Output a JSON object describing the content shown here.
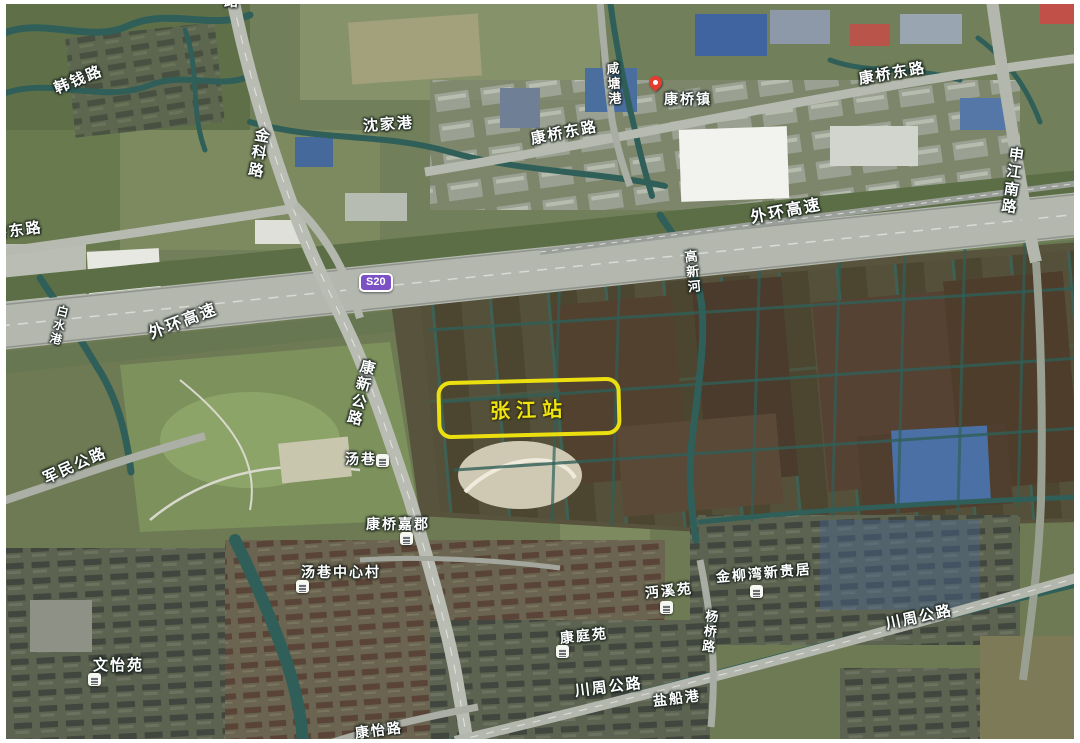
{
  "map": {
    "type": "satellite",
    "station_annotation": {
      "label": "张江站",
      "box": {
        "x": 437,
        "y": 379,
        "w": 176,
        "h": 50
      }
    },
    "road_badge": {
      "text": "S20",
      "x": 359,
      "y": 273
    },
    "town_pin": {
      "poi": "康桥镇",
      "x": 649,
      "y": 76
    },
    "labels": [
      {
        "id": "hanqian-rd",
        "text": "韩钱路",
        "x": 55,
        "y": 82,
        "rotate": -22,
        "size": 15
      },
      {
        "id": "top-edge-road-partial",
        "text": "路",
        "x": 224,
        "y": -6,
        "rotate": 0,
        "size": 14
      },
      {
        "id": "jinke-rd",
        "text": "金科路",
        "x": 256,
        "y": 128,
        "rotate": 10,
        "size": 15,
        "vertical": true
      },
      {
        "id": "shenjiagang-river",
        "text": "沈家港",
        "x": 363,
        "y": 119,
        "rotate": -4,
        "size": 15
      },
      {
        "id": "qiaodong-rd-left",
        "text": "桥东路",
        "x": -8,
        "y": 227,
        "rotate": -8,
        "size": 15
      },
      {
        "id": "kangqiao-east-rd-mid",
        "text": "康桥东路",
        "x": 531,
        "y": 132,
        "rotate": -11,
        "size": 15
      },
      {
        "id": "xiantang-gang-river",
        "text": "咸塘港",
        "x": 606,
        "y": 62,
        "rotate": -4,
        "size": 13,
        "vertical": true
      },
      {
        "id": "kangqiao-town",
        "text": "康桥镇",
        "x": 664,
        "y": 92,
        "rotate": 0,
        "size": 14
      },
      {
        "id": "kangqiao-east-rd-right",
        "text": "康桥东路",
        "x": 859,
        "y": 72,
        "rotate": -10,
        "size": 15
      },
      {
        "id": "shenjiang-south-rd",
        "text": "申江南路",
        "x": 1010,
        "y": 147,
        "rotate": 8,
        "size": 15,
        "vertical": true
      },
      {
        "id": "outer-ring-expwy-right",
        "text": "外环高速",
        "x": 751,
        "y": 211,
        "rotate": -11,
        "size": 16
      },
      {
        "id": "gaoxin-river",
        "text": "高新河",
        "x": 684,
        "y": 250,
        "rotate": -6,
        "size": 13,
        "vertical": true
      },
      {
        "id": "outer-ring-expwy-left",
        "text": "外环高速",
        "x": 150,
        "y": 327,
        "rotate": -21,
        "size": 16
      },
      {
        "id": "baishui-gang-river",
        "text": "白水港",
        "x": 58,
        "y": 306,
        "rotate": 14,
        "size": 12,
        "vertical": true
      },
      {
        "id": "kangxin-hwy",
        "text": "康新公路",
        "x": 362,
        "y": 360,
        "rotate": 14,
        "size": 15,
        "vertical": true
      },
      {
        "id": "tangxiang",
        "text": "汤巷",
        "x": 345,
        "y": 452,
        "rotate": 0,
        "size": 14
      },
      {
        "id": "junmin-hwy",
        "text": "军民公路",
        "x": 44,
        "y": 472,
        "rotate": -24,
        "size": 15
      },
      {
        "id": "kangqiao-jiajun",
        "text": "康桥嘉郡",
        "x": 366,
        "y": 517,
        "rotate": 0,
        "size": 14
      },
      {
        "id": "tangxiang-center-village",
        "text": "汤巷中心村",
        "x": 301,
        "y": 565,
        "rotate": 0,
        "size": 14
      },
      {
        "id": "wenyi-garden",
        "text": "文怡苑",
        "x": 93,
        "y": 658,
        "rotate": 0,
        "size": 15
      },
      {
        "id": "kangting-garden",
        "text": "康庭苑",
        "x": 560,
        "y": 631,
        "rotate": -6,
        "size": 14
      },
      {
        "id": "mianxi-garden",
        "text": "沔溪苑",
        "x": 645,
        "y": 586,
        "rotate": -6,
        "size": 14
      },
      {
        "id": "jinliuwan-xinguiju",
        "text": "金柳湾新贵居",
        "x": 716,
        "y": 570,
        "rotate": -5,
        "size": 14
      },
      {
        "id": "yangqiao-rd",
        "text": "杨桥路",
        "x": 706,
        "y": 610,
        "rotate": 6,
        "size": 13,
        "vertical": true
      },
      {
        "id": "chuanzhou-hwy-bottom",
        "text": "川周公路",
        "x": 575,
        "y": 684,
        "rotate": -7,
        "size": 15
      },
      {
        "id": "yanchuan-gang-river",
        "text": "盐船港",
        "x": 653,
        "y": 694,
        "rotate": -7,
        "size": 14
      },
      {
        "id": "chuanzhou-hwy-right",
        "text": "川周公路",
        "x": 886,
        "y": 617,
        "rotate": -12,
        "size": 15
      },
      {
        "id": "kangyi-rd",
        "text": "康怡路",
        "x": 355,
        "y": 726,
        "rotate": -7,
        "size": 14
      }
    ],
    "pois": [
      {
        "id": "poi-tangxiang",
        "x": 376,
        "y": 454
      },
      {
        "id": "poi-kangqiao-jiajun",
        "x": 400,
        "y": 532
      },
      {
        "id": "poi-tangxiang-center",
        "x": 296,
        "y": 580
      },
      {
        "id": "poi-wenyi-garden",
        "x": 88,
        "y": 673
      },
      {
        "id": "poi-kangting-garden",
        "x": 556,
        "y": 645
      },
      {
        "id": "poi-mianxi-garden",
        "x": 660,
        "y": 601
      },
      {
        "id": "poi-jinliuwan",
        "x": 750,
        "y": 585
      }
    ]
  },
  "colors": {
    "station_box_border": "#ecdf10",
    "station_text": "#f0e312",
    "badge_background": "#7b51c3",
    "pin_red": "#e23d2e",
    "label_text": "#ffffff",
    "water": "#2f5f58"
  }
}
